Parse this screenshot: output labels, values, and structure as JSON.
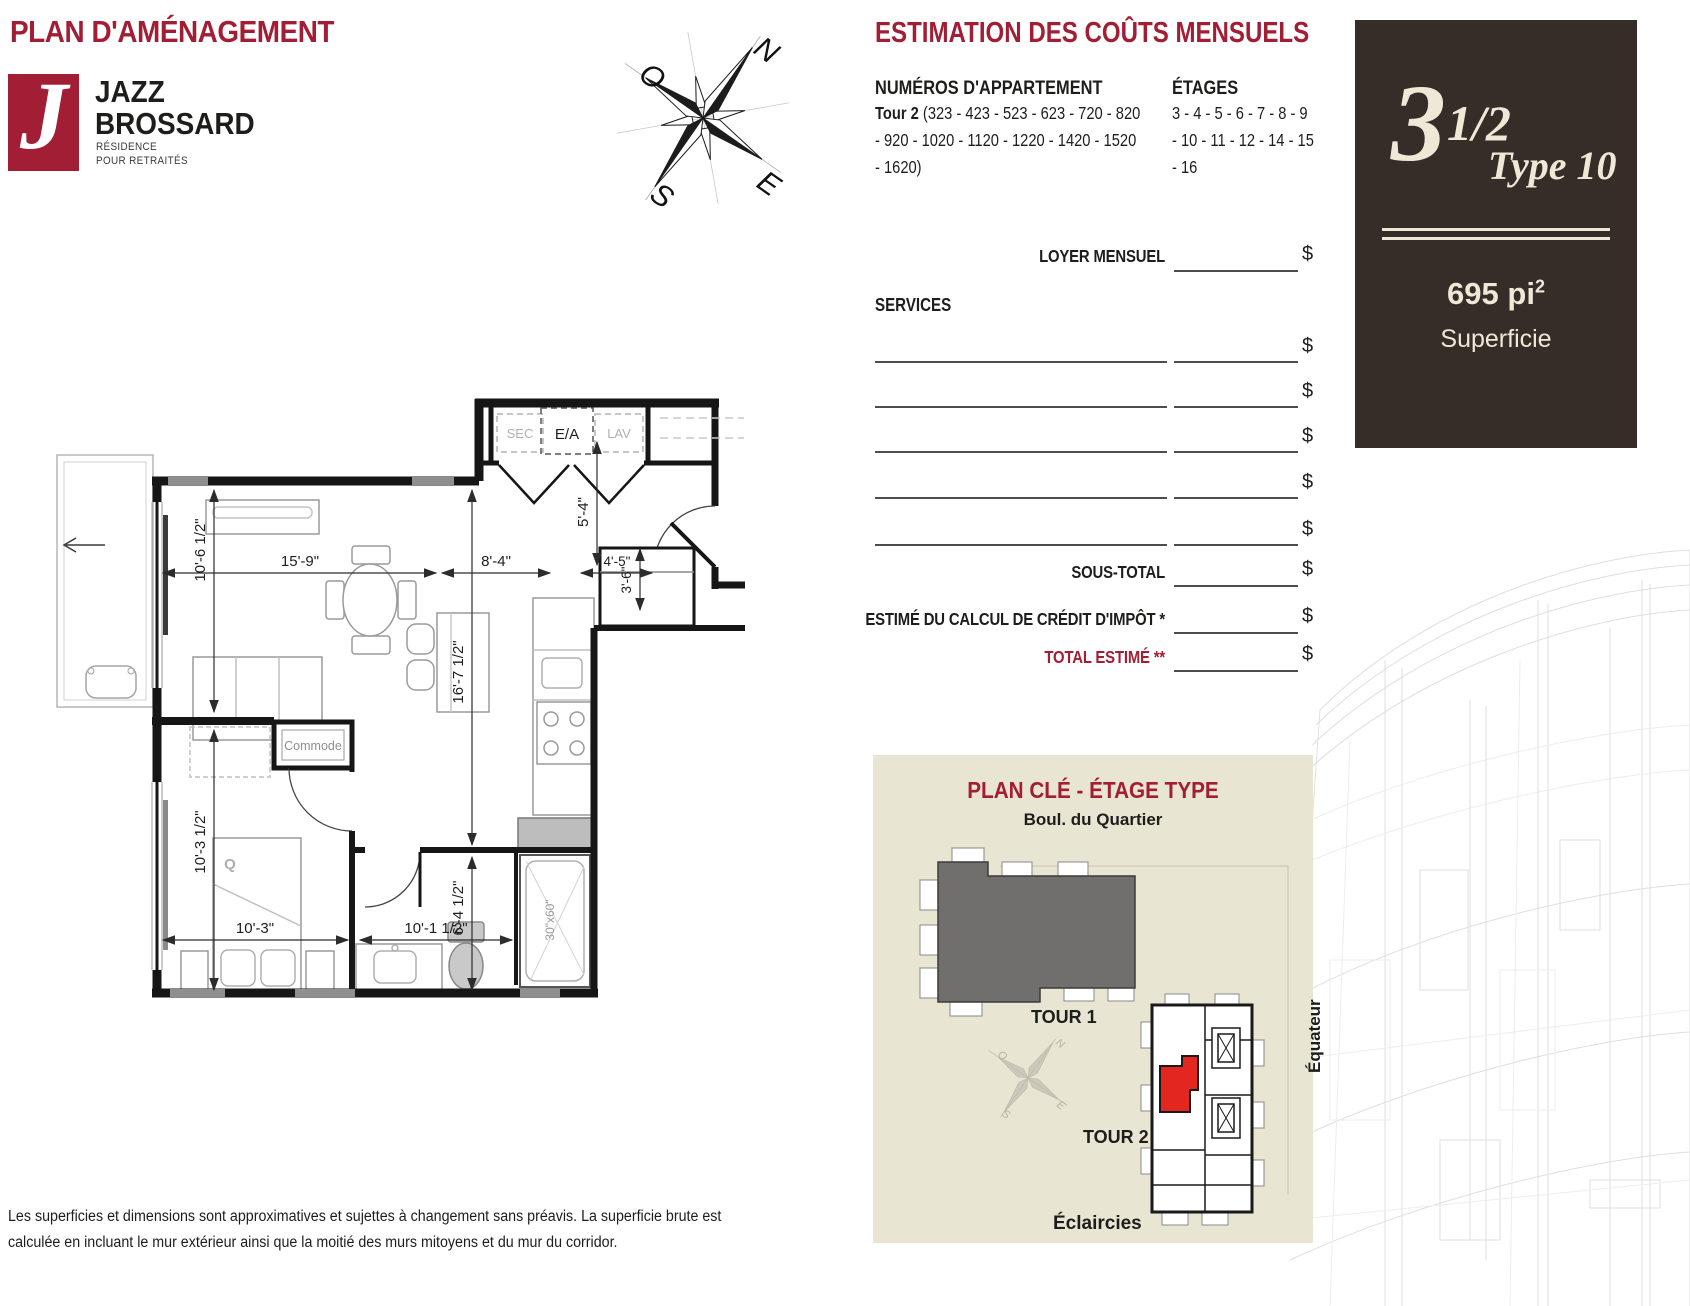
{
  "page": {
    "title": "PLAN D'AMÉNAGEMENT"
  },
  "logo": {
    "glyph": "J",
    "line1": "JAZZ",
    "line2": "BROSSARD",
    "sub1": "RÉSIDENCE",
    "sub2": "POUR RETRAITÉS"
  },
  "compass": {
    "n": "N",
    "s": "S",
    "e": "E",
    "o": "O"
  },
  "estimation": {
    "title": "ESTIMATION DES COÛTS MENSUELS",
    "apartments_heading": "NUMÉROS D'APPARTEMENT",
    "tower_label": "Tour 2",
    "apartments_line1": "(323 - 423 - 523 - 623 - 720 - 820",
    "apartments_line2": "- 920 - 1020 - 1120 - 1220 - 1420 - 1520",
    "apartments_line3": "- 1620)",
    "floors_heading": "ÉTAGES",
    "floors_line1": "3 - 4 - 5 - 6 - 7 - 8 - 9",
    "floors_line2": "- 10 - 11 - 12 - 14 - 15",
    "floors_line3": "- 16",
    "loyer_label": "LOYER MENSUEL",
    "services_label": "SERVICES",
    "sous_total_label": "SOUS-TOTAL",
    "credit_label": "ESTIMÉ DU CALCUL DE CRÉDIT D'IMPÔT *",
    "total_label": "TOTAL ESTIMÉ **",
    "currency": "$"
  },
  "unit_card": {
    "number": "3",
    "fraction": "1/2",
    "type": "Type 10",
    "area": "695 pi",
    "area_sup": "2",
    "area_label": "Superficie"
  },
  "floor_plan": {
    "dims": {
      "living_width": "15'-9\"",
      "living_height": "10'-6 1/2\"",
      "kitchen_width": "8'-4\"",
      "entry_width": "4'-5\"",
      "entry_depth": "3'-6\"",
      "hall_depth": "5'-4\"",
      "unit_depth": "16'-7 1/2\"",
      "bedroom_height": "10'-3 1/2\"",
      "bedroom_width": "10'-3\"",
      "bathroom_width": "10'-1 1/2\"",
      "bathroom_height": "6'-4 1/2\"",
      "tub": "30\"x60\""
    },
    "labels": {
      "laundry_sec": "SEC",
      "laundry_ea": "E/A",
      "laundry_lav": "LAV",
      "commode": "Commode",
      "bed": "Q"
    }
  },
  "key_plan": {
    "title": "PLAN CLÉ - ÉTAGE TYPE",
    "street_top": "Boul. du Quartier",
    "tower1": "TOUR 1",
    "tower2": "TOUR 2",
    "street_bottom": "Éclaircies",
    "street_right": "Équateur",
    "compass": {
      "n": "N",
      "s": "S",
      "e": "E",
      "o": "O"
    }
  },
  "disclaimer": {
    "line1": "Les superficies et dimensions sont approximatives et sujettes à changement sans préavis. La superficie brute est",
    "line2": "calculée en incluant le mur extérieur ainsi que la moitié des murs mitoyens et du mur du corridor."
  },
  "colors": {
    "accent": "#A21E35",
    "card_bg": "#362D29",
    "card_text": "#EFE8D7",
    "keyplan_bg": "#E9E5D3",
    "tower1_gray": "#706F6D",
    "unit_red": "#E3261F"
  }
}
